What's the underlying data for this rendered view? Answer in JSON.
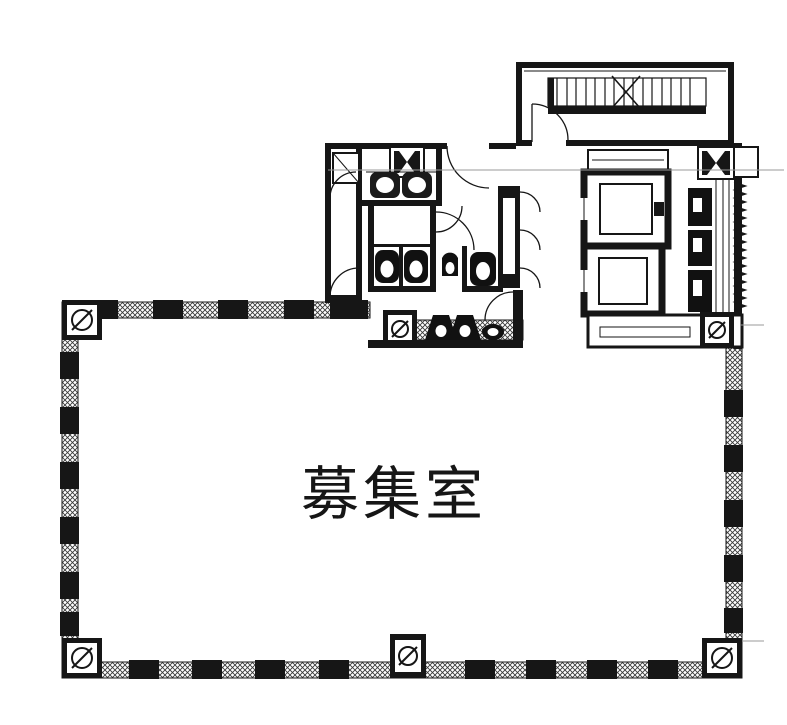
{
  "floor_plan": {
    "room_label": "募集室",
    "ink_color": "#161616",
    "background_color": "#ffffff",
    "centerline_color": "#9a9a9a",
    "core": {
      "staircase_count": 1,
      "elevator_count": 2,
      "toilet_count": 3,
      "urinal_count": 2,
      "sink_count": 3,
      "marked_column_count": 6
    }
  }
}
